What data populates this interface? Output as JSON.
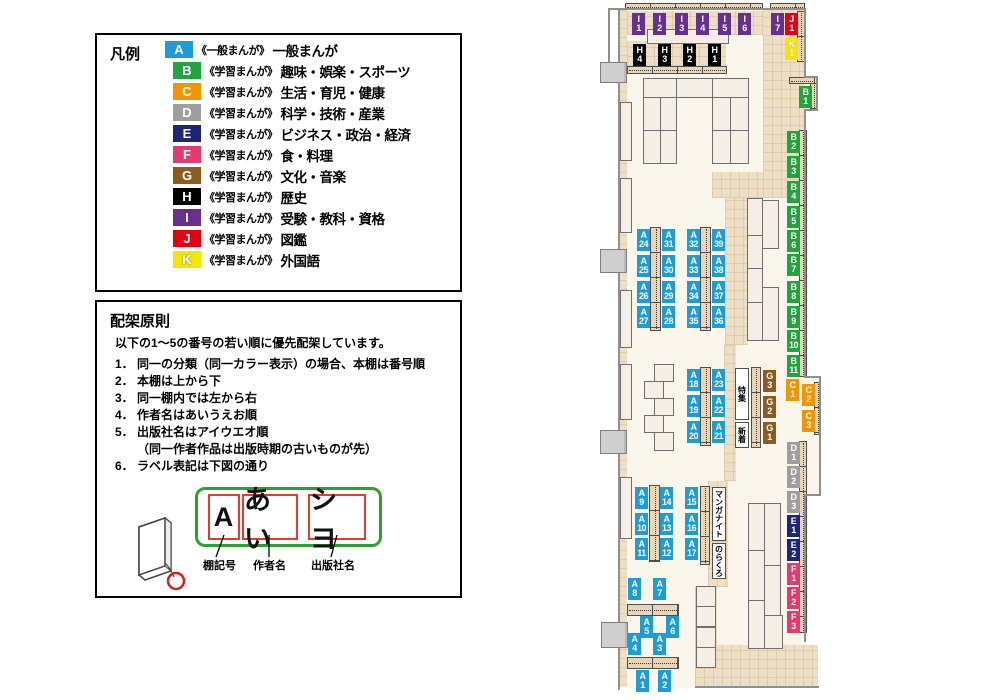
{
  "legend": {
    "title": "凡例",
    "items": [
      {
        "letter": "A",
        "color": "#1E9CD7",
        "category": "《一般まんが》",
        "label": "一般まんが"
      },
      {
        "letter": "B",
        "color": "#1FA53C",
        "category": "《学習まんが》",
        "label": "趣味・娯楽・スポーツ"
      },
      {
        "letter": "C",
        "color": "#F29600",
        "category": "《学習まんが》",
        "label": "生活・育児・健康"
      },
      {
        "letter": "D",
        "color": "#9E9E9F",
        "category": "《学習まんが》",
        "label": "科学・技術・産業"
      },
      {
        "letter": "E",
        "color": "#1D2577",
        "category": "《学習まんが》",
        "label": "ビジネス・政治・経済"
      },
      {
        "letter": "F",
        "color": "#E6396F",
        "category": "《学習まんが》",
        "label": "食・料理"
      },
      {
        "letter": "G",
        "color": "#8B5B1F",
        "category": "《学習まんが》",
        "label": "文化・音楽"
      },
      {
        "letter": "H",
        "color": "#000000",
        "category": "《学習まんが》",
        "label": "歴史"
      },
      {
        "letter": "I",
        "color": "#672F90",
        "category": "《学習まんが》",
        "label": "受験・教科・資格"
      },
      {
        "letter": "J",
        "color": "#E60012",
        "category": "《学習まんが》",
        "label": "図鑑"
      },
      {
        "letter": "K",
        "color": "#F5E600",
        "category": "《学習まんが》",
        "label": "外国語"
      }
    ]
  },
  "principles": {
    "title": "配架原則",
    "intro": "以下の1～5の番号の若い順に優先配架しています。",
    "rules": [
      {
        "num": "1．",
        "text": "同一の分類（同一カラー表示）の場合、本棚は番号順"
      },
      {
        "num": "2．",
        "text": "本棚は上から下"
      },
      {
        "num": "3．",
        "text": "同一棚内では左から右"
      },
      {
        "num": "4．",
        "text": "作者名はあいうえお順"
      },
      {
        "num": "5．",
        "text": "出版社名はアイウエオ順",
        "sub": "（同一作者作品は出版時期の古いものが先）"
      },
      {
        "num": "6．",
        "text": "ラベル表記は下図の通り"
      }
    ],
    "label_diagram": {
      "segments": [
        "A",
        "あい",
        "シヨ"
      ],
      "captions": [
        "棚記号",
        "作者名",
        "出版社名"
      ]
    }
  },
  "map": {
    "shelf_tags": [
      {
        "letter": "I",
        "num": "1",
        "x": 632,
        "y": 13
      },
      {
        "letter": "I",
        "num": "2",
        "x": 653,
        "y": 13
      },
      {
        "letter": "I",
        "num": "3",
        "x": 675,
        "y": 13
      },
      {
        "letter": "I",
        "num": "4",
        "x": 696,
        "y": 13
      },
      {
        "letter": "I",
        "num": "5",
        "x": 718,
        "y": 13
      },
      {
        "letter": "I",
        "num": "6",
        "x": 738,
        "y": 13
      },
      {
        "letter": "I",
        "num": "7",
        "x": 771,
        "y": 13
      },
      {
        "letter": "J",
        "num": "1",
        "x": 785,
        "y": 13
      },
      {
        "letter": "K",
        "num": "1",
        "x": 785,
        "y": 38
      },
      {
        "letter": "H",
        "num": "4",
        "x": 633,
        "y": 44
      },
      {
        "letter": "H",
        "num": "3",
        "x": 658,
        "y": 44
      },
      {
        "letter": "H",
        "num": "2",
        "x": 683,
        "y": 44
      },
      {
        "letter": "H",
        "num": "1",
        "x": 708,
        "y": 44
      },
      {
        "letter": "B",
        "num": "1",
        "x": 799,
        "y": 86
      },
      {
        "letter": "B",
        "num": "2",
        "x": 787,
        "y": 131
      },
      {
        "letter": "B",
        "num": "3",
        "x": 787,
        "y": 156
      },
      {
        "letter": "B",
        "num": "4",
        "x": 787,
        "y": 181
      },
      {
        "letter": "B",
        "num": "5",
        "x": 787,
        "y": 206
      },
      {
        "letter": "B",
        "num": "6",
        "x": 787,
        "y": 230
      },
      {
        "letter": "B",
        "num": "7",
        "x": 787,
        "y": 254
      },
      {
        "letter": "B",
        "num": "8",
        "x": 787,
        "y": 281
      },
      {
        "letter": "B",
        "num": "9",
        "x": 787,
        "y": 306
      },
      {
        "letter": "B",
        "num": "10",
        "x": 787,
        "y": 330
      },
      {
        "letter": "B",
        "num": "11",
        "x": 787,
        "y": 355
      },
      {
        "letter": "C",
        "num": "1",
        "x": 786,
        "y": 379
      },
      {
        "letter": "C",
        "num": "2",
        "x": 802,
        "y": 384
      },
      {
        "letter": "C",
        "num": "3",
        "x": 802,
        "y": 410
      },
      {
        "letter": "G",
        "num": "3",
        "x": 763,
        "y": 370
      },
      {
        "letter": "G",
        "num": "2",
        "x": 763,
        "y": 396
      },
      {
        "letter": "G",
        "num": "1",
        "x": 763,
        "y": 422
      },
      {
        "letter": "D",
        "num": "1",
        "x": 787,
        "y": 442
      },
      {
        "letter": "D",
        "num": "2",
        "x": 787,
        "y": 466
      },
      {
        "letter": "D",
        "num": "3",
        "x": 787,
        "y": 491
      },
      {
        "letter": "E",
        "num": "1",
        "x": 787,
        "y": 515
      },
      {
        "letter": "E",
        "num": "2",
        "x": 787,
        "y": 539
      },
      {
        "letter": "F",
        "num": "1",
        "x": 787,
        "y": 563
      },
      {
        "letter": "F",
        "num": "2",
        "x": 787,
        "y": 587
      },
      {
        "letter": "F",
        "num": "3",
        "x": 787,
        "y": 611
      },
      {
        "letter": "A",
        "num": "24",
        "x": 637,
        "y": 229
      },
      {
        "letter": "A",
        "num": "31",
        "x": 662,
        "y": 229
      },
      {
        "letter": "A",
        "num": "25",
        "x": 637,
        "y": 255
      },
      {
        "letter": "A",
        "num": "30",
        "x": 662,
        "y": 255
      },
      {
        "letter": "A",
        "num": "26",
        "x": 637,
        "y": 281
      },
      {
        "letter": "A",
        "num": "29",
        "x": 662,
        "y": 281
      },
      {
        "letter": "A",
        "num": "27",
        "x": 637,
        "y": 306
      },
      {
        "letter": "A",
        "num": "28",
        "x": 662,
        "y": 306
      },
      {
        "letter": "A",
        "num": "32",
        "x": 687,
        "y": 229
      },
      {
        "letter": "A",
        "num": "39",
        "x": 712,
        "y": 229
      },
      {
        "letter": "A",
        "num": "33",
        "x": 687,
        "y": 255
      },
      {
        "letter": "A",
        "num": "38",
        "x": 712,
        "y": 255
      },
      {
        "letter": "A",
        "num": "34",
        "x": 687,
        "y": 281
      },
      {
        "letter": "A",
        "num": "37",
        "x": 712,
        "y": 281
      },
      {
        "letter": "A",
        "num": "35",
        "x": 687,
        "y": 306
      },
      {
        "letter": "A",
        "num": "36",
        "x": 712,
        "y": 306
      },
      {
        "letter": "A",
        "num": "18",
        "x": 687,
        "y": 369
      },
      {
        "letter": "A",
        "num": "23",
        "x": 712,
        "y": 369
      },
      {
        "letter": "A",
        "num": "19",
        "x": 687,
        "y": 395
      },
      {
        "letter": "A",
        "num": "22",
        "x": 712,
        "y": 395
      },
      {
        "letter": "A",
        "num": "20",
        "x": 687,
        "y": 421
      },
      {
        "letter": "A",
        "num": "21",
        "x": 712,
        "y": 421
      },
      {
        "letter": "A",
        "num": "9",
        "x": 635,
        "y": 487
      },
      {
        "letter": "A",
        "num": "14",
        "x": 660,
        "y": 487
      },
      {
        "letter": "A",
        "num": "10",
        "x": 635,
        "y": 513
      },
      {
        "letter": "A",
        "num": "13",
        "x": 660,
        "y": 513
      },
      {
        "letter": "A",
        "num": "11",
        "x": 635,
        "y": 538
      },
      {
        "letter": "A",
        "num": "12",
        "x": 660,
        "y": 538
      },
      {
        "letter": "A",
        "num": "15",
        "x": 685,
        "y": 487
      },
      {
        "letter": "A",
        "num": "16",
        "x": 685,
        "y": 513
      },
      {
        "letter": "A",
        "num": "17",
        "x": 685,
        "y": 538
      },
      {
        "letter": "A",
        "num": "8",
        "x": 628,
        "y": 578
      },
      {
        "letter": "A",
        "num": "7",
        "x": 653,
        "y": 578
      },
      {
        "letter": "A",
        "num": "5",
        "x": 640,
        "y": 616
      },
      {
        "letter": "A",
        "num": "6",
        "x": 666,
        "y": 616
      },
      {
        "letter": "A",
        "num": "4",
        "x": 628,
        "y": 633
      },
      {
        "letter": "A",
        "num": "3",
        "x": 653,
        "y": 633
      },
      {
        "letter": "A",
        "num": "1",
        "x": 636,
        "y": 670
      },
      {
        "letter": "A",
        "num": "2",
        "x": 658,
        "y": 670
      }
    ],
    "area_labels": [
      {
        "id": "tokushu",
        "text": "特集",
        "x": 735,
        "y": 368,
        "w": 14,
        "h": 52
      },
      {
        "id": "shinchaku",
        "text": "新着",
        "x": 735,
        "y": 422,
        "w": 14,
        "h": 26
      },
      {
        "id": "manga-night",
        "text": "マンガナイト",
        "x": 712,
        "y": 487,
        "w": 14,
        "h": 54
      },
      {
        "id": "norakuro",
        "text": "のらくろ",
        "x": 712,
        "y": 543,
        "w": 14,
        "h": 36
      }
    ]
  }
}
